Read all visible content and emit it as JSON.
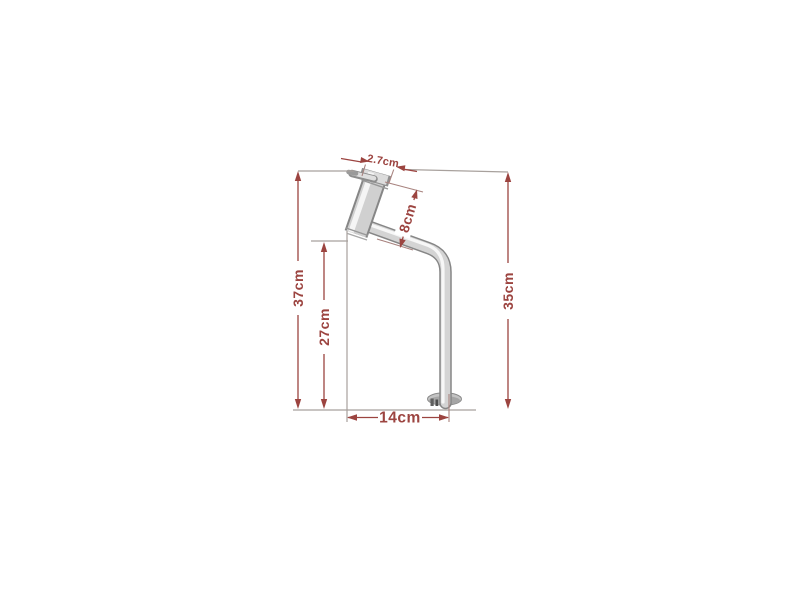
{
  "diagram": {
    "title": "faucet-dimension-drawing",
    "background_color": "#ffffff",
    "colors": {
      "dimension_red": "#9c4440",
      "extension_gray": "#a8a19d",
      "extension_red": "#a8837f",
      "chrome_edge": "#8e8e8e",
      "chrome_mid": "#d4d4d4",
      "chrome_highlight": "#f7f7f7"
    },
    "dimensions": {
      "total_height": "37cm",
      "inner_height": "27cm",
      "right_height": "35cm",
      "body_length": "8cm",
      "body_diameter": "2.7cm",
      "base_width": "14cm"
    }
  }
}
